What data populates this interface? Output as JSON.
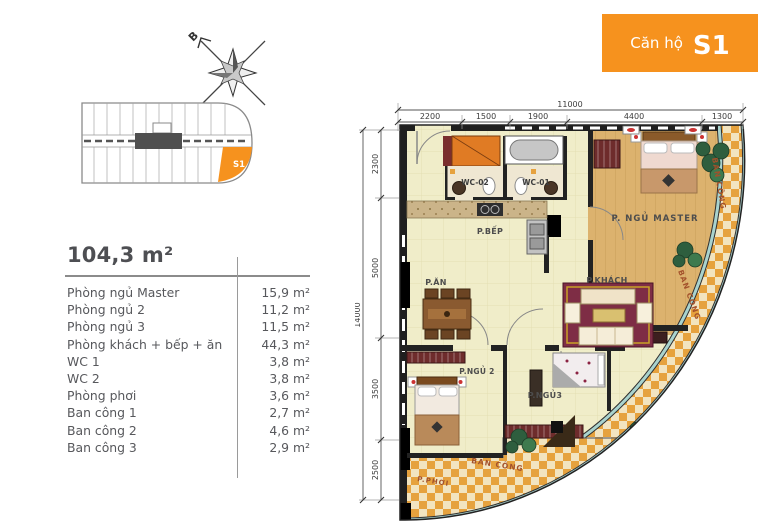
{
  "badge": {
    "label": "Căn hộ",
    "unit": "S1"
  },
  "compass": {
    "north_label": "B"
  },
  "key_plan": {
    "unit_label": "S1"
  },
  "summary": {
    "total_area": "104,3 m²",
    "rows": [
      {
        "label": "Phòng ngủ Master",
        "value": "15,9 m²"
      },
      {
        "label": "Phòng ngủ 2",
        "value": "11,2 m²"
      },
      {
        "label": "Phòng ngủ 3",
        "value": "11,5 m²"
      },
      {
        "label": "Phòng khách + bếp + ăn",
        "value": "44,3 m²"
      },
      {
        "label": "WC 1",
        "value": "3,8 m²"
      },
      {
        "label": "WC 2",
        "value": "3,8 m²"
      },
      {
        "label": "Phòng phơi",
        "value": "3,6 m²"
      },
      {
        "label": "Ban công 1",
        "value": "2,7 m²"
      },
      {
        "label": "Ban công 2",
        "value": "4,6 m²"
      },
      {
        "label": "Ban công 3",
        "value": "2,9 m²"
      }
    ]
  },
  "plan": {
    "dim_top_total": "11000",
    "dim_top_segments": [
      "2200",
      "1500",
      "1900",
      "4400",
      "1300"
    ],
    "dim_left_total": "14000",
    "dim_left_segments": [
      "2300",
      "5000",
      "3500",
      "2500"
    ],
    "rooms": {
      "wc02": "WC-02",
      "wc01": "WC-01",
      "master": "P. NGỦ MASTER",
      "kitchen": "P.BẾP",
      "dining": "P.ĂN",
      "living": "P.KHÁCH",
      "bed2": "P.NGỦ 2",
      "bed3": "P.NGỦ3",
      "balcony1": "BAN CÔNG",
      "balcony2": "BAN CÔNG",
      "balcony3": "BAN CÔNG",
      "laundry": "P.PHƠI"
    }
  },
  "colors": {
    "accent": "#F6921E",
    "text": "#57585C",
    "checker": "#E6A23E",
    "glass": "#A9D3CE"
  }
}
